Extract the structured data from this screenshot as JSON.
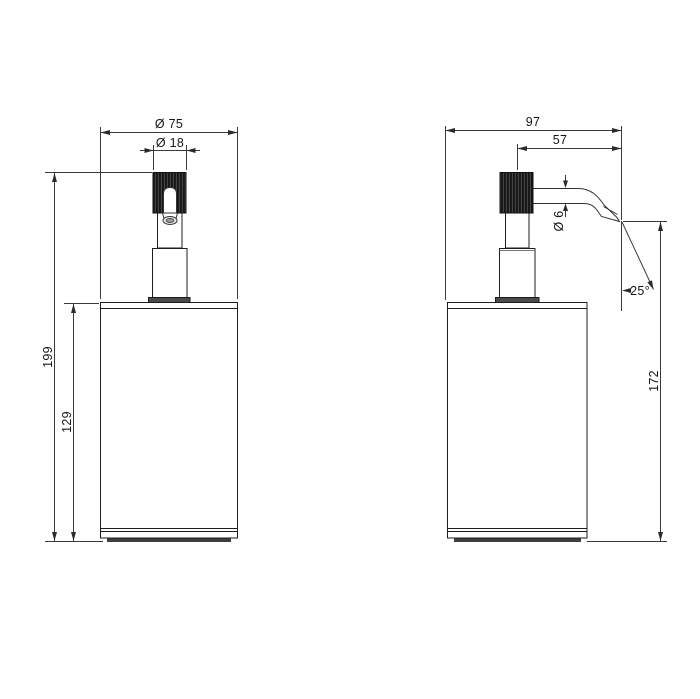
{
  "drawing": {
    "type": "technical-dimension-drawing",
    "subject": "freestanding soap dispenser with pump spout",
    "background_color": "#ffffff",
    "line_color": "#2b2b2b",
    "knob_fill_color": "#161616",
    "views": [
      {
        "id": "front-view",
        "description": "front elevation of dispenser"
      },
      {
        "id": "side-view",
        "description": "side elevation of dispenser with spout"
      }
    ],
    "dimensions": {
      "body_diameter": "Ø 75",
      "knob_diameter": "Ø 18",
      "total_height": "199",
      "body_height": "129",
      "total_depth": "97",
      "spout_reach": "57",
      "spout_diameter": "Ø 6",
      "spout_angle": "25°",
      "spout_outlet_height": "172"
    }
  }
}
